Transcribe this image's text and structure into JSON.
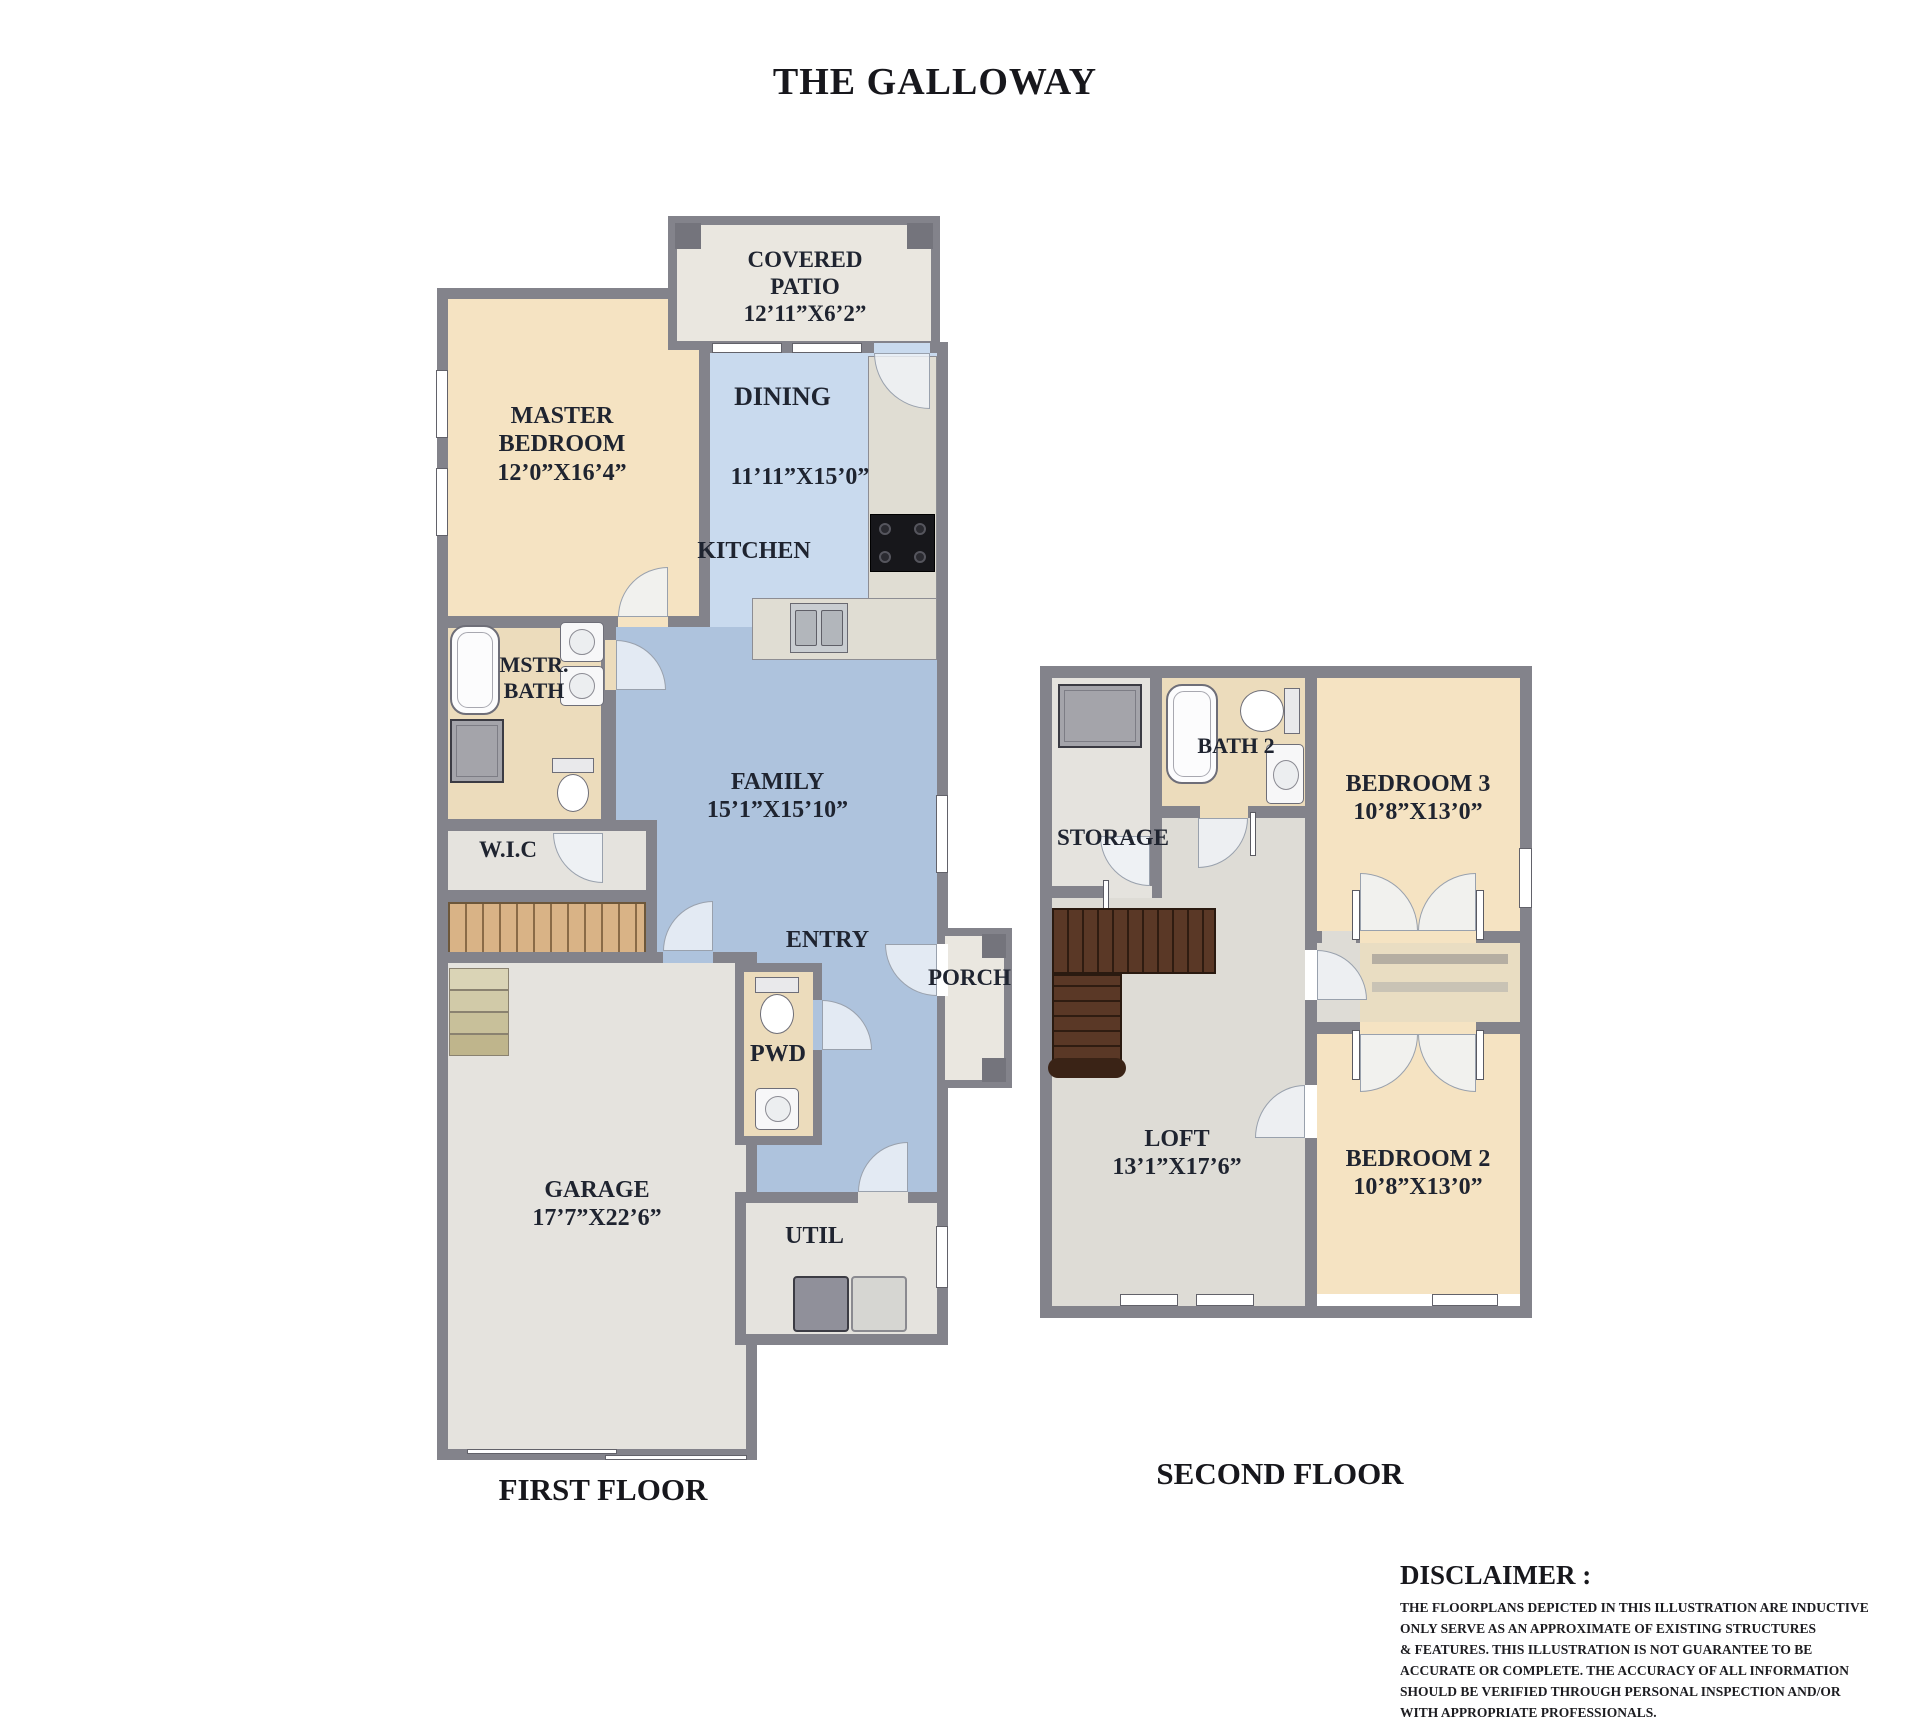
{
  "title": "THE GALLOWAY",
  "palette": {
    "wall": "#83838b",
    "bedroom_fill": "#f5e3c2",
    "dining_kitchen_fill": "#c9daee",
    "family_fill": "#aec3dd",
    "gray_room_fill": "#e5e3de",
    "bath_fill": "#ecdcbc",
    "patio_fill": "#eae7e0",
    "stairs_wood": "#d9b386",
    "stairs_dark_wood": "#5a3826",
    "label_color": "#1f2430"
  },
  "first_floor": {
    "caption": "FIRST FLOOR",
    "rooms": {
      "covered_patio": {
        "name": "COVERED PATIO",
        "dims": "12’11”X6’2”"
      },
      "master_bedroom": {
        "name": "MASTER BEDROOM",
        "dims": "12’0”X16’4”"
      },
      "dining": {
        "name": "DINING",
        "dims": "11’11”X15’0”"
      },
      "kitchen": {
        "name": "KITCHEN"
      },
      "master_bath": {
        "name": "MSTR. BATH"
      },
      "wic": {
        "name": "W.I.C"
      },
      "family": {
        "name": "FAMILY",
        "dims": "15’1”X15’10”"
      },
      "entry": {
        "name": "ENTRY"
      },
      "porch": {
        "name": "PORCH"
      },
      "powder": {
        "name": "PWD"
      },
      "garage": {
        "name": "GARAGE",
        "dims": "17’7”X22’6”"
      },
      "utility": {
        "name": "UTIL"
      }
    }
  },
  "second_floor": {
    "caption": "SECOND FLOOR",
    "rooms": {
      "storage": {
        "name": "STORAGE"
      },
      "bath2": {
        "name": "BATH 2"
      },
      "bedroom3": {
        "name": "BEDROOM 3",
        "dims": "10’8”X13’0”"
      },
      "loft": {
        "name": "LOFT",
        "dims": "13’1”X17’6”"
      },
      "bedroom2": {
        "name": "BEDROOM 2",
        "dims": "10’8”X13’0”"
      }
    }
  },
  "disclaimer": {
    "heading": "DISCLAIMER :",
    "lines": [
      "THE FLOORPLANS DEPICTED IN THIS ILLUSTRATION ARE INDUCTIVE",
      "ONLY SERVE AS AN APPROXIMATE OF EXISTING STRUCTURES",
      "& FEATURES. THIS ILLUSTRATION IS NOT GUARANTEE TO BE",
      "ACCURATE OR COMPLETE. THE ACCURACY OF ALL INFORMATION",
      "SHOULD BE VERIFIED THROUGH PERSONAL  INSPECTION AND/OR",
      "WITH APPROPRIATE PROFESSIONALS."
    ]
  }
}
